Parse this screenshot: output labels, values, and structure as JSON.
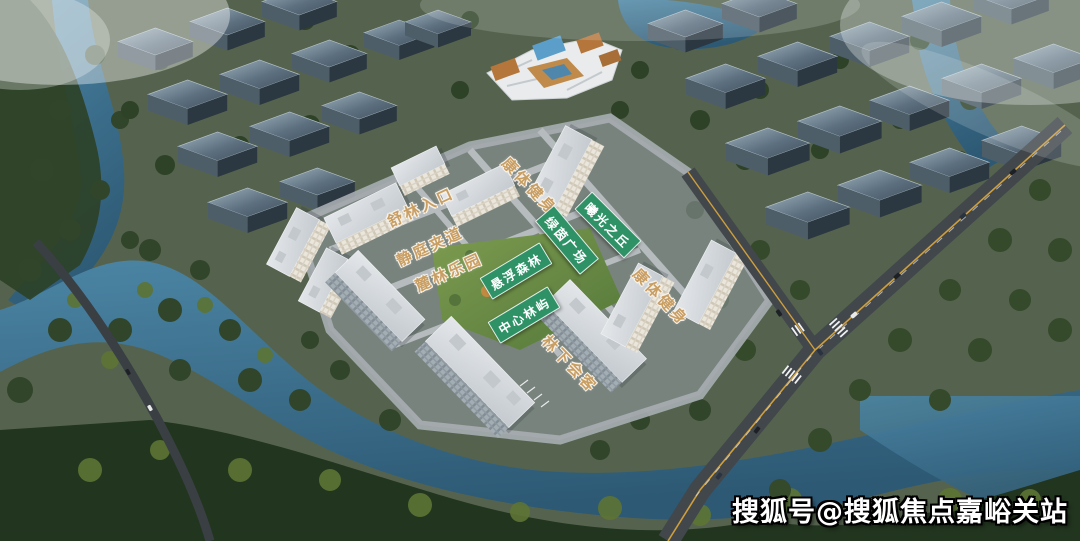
{
  "scene": {
    "type": "aerial-masterplan-rendering",
    "colors": {
      "label_tan": "#c99e63",
      "label_green_bg": "#2e9266",
      "label_text_green": "#ffffff",
      "water": "#3f7493",
      "tree_dark": "#2c4026",
      "road": "#42474c",
      "road_centerline_yellow": "#cf9f3c",
      "residential_white": "#e8e4da",
      "industrial_block": "#5d7080"
    },
    "labels": [
      {
        "text": "舒林入口",
        "style": "tan",
        "x": 421,
        "y": 207,
        "angle": -25
      },
      {
        "text": "静庭夹道",
        "style": "tan",
        "x": 430,
        "y": 246,
        "angle": -25
      },
      {
        "text": "麓林乐园",
        "style": "tan",
        "x": 449,
        "y": 272,
        "angle": -24
      },
      {
        "text": "悬浮森林",
        "style": "green",
        "x": 516,
        "y": 271,
        "angle": -31
      },
      {
        "text": "中心林屿",
        "style": "green",
        "x": 524,
        "y": 315,
        "angle": -31
      },
      {
        "text": "康体健身",
        "style": "tan",
        "x": 530,
        "y": 186,
        "angle": 46
      },
      {
        "text": "曦光之丘",
        "style": "green",
        "x": 608,
        "y": 225,
        "angle": 45
      },
      {
        "text": "绿茵广场",
        "style": "green",
        "x": 567,
        "y": 240,
        "angle": 50
      },
      {
        "text": "康体健身",
        "style": "tan",
        "x": 661,
        "y": 297,
        "angle": 46
      },
      {
        "text": "林下会客",
        "style": "tan",
        "x": 570,
        "y": 364,
        "angle": 46
      }
    ],
    "watermark": {
      "text": "搜狐号@搜狐焦点嘉峪关站"
    }
  }
}
